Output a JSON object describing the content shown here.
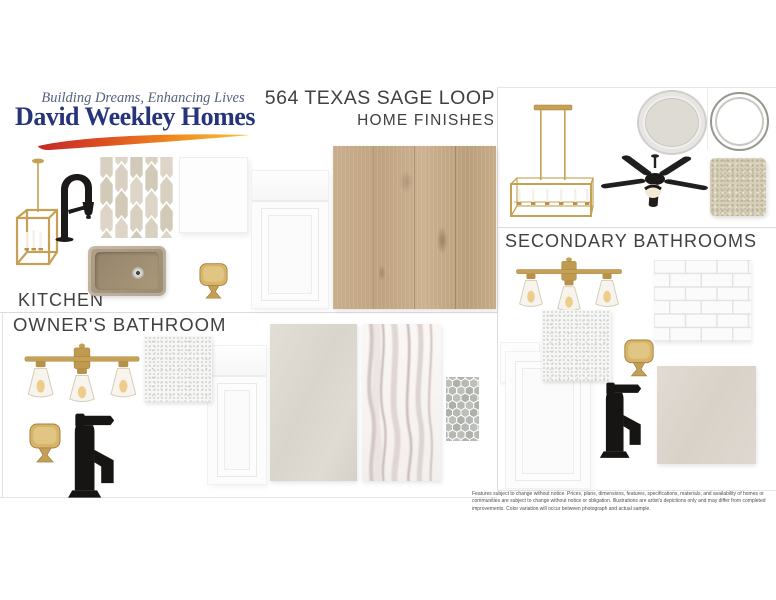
{
  "header": {
    "tagline": "Building Dreams, Enhancing Lives",
    "brand": "David Weekley Homes",
    "address": "564 TEXAS SAGE LOOP",
    "subtitle": "HOME FINISHES"
  },
  "sections": {
    "kitchen": "KITCHEN",
    "owners_bathroom": "OWNER'S BATHROOM",
    "secondary_bathrooms": "SECONDARY BATHROOMS"
  },
  "disclaimer": "Features subject to change without notice. Prices, plans, dimensions, features, specifications, materials, and availability of homes or communities are subject to change without notice or obligation. Illustrations are artist's depictions only and may differ from completed improvements. Color variation will occur between photograph and actual sample.",
  "colors": {
    "brand_navy": "#26357b",
    "tagline_blue_gray": "#566180",
    "heading_gray": "#414042",
    "brass_gold": "#c6a055",
    "matte_black": "#1c1a18",
    "swoosh_red": "#c22a27",
    "swoosh_orange": "#f08c1e",
    "swoosh_yellow": "#f6c33c",
    "sink_bronze": "#a3917a",
    "oak_floor": "#c3a887",
    "carpet_cream": "#d6cfba",
    "picket_tile_beige": "#d8d0c1",
    "hex_tile_gray": "#b6b9b3"
  },
  "products": {
    "kitchen": [
      "gold-lantern-pendant-light",
      "matte-black-pulldown-kitchen-faucet",
      "beige-picket-mosaic-tile",
      "white-square-tile",
      "bronze-single-bowl-kitchen-sink",
      "brass-cabinet-knob",
      "white-shaker-cabinet-door",
      "light-oak-wood-flooring"
    ],
    "owners_bathroom": [
      "brass-3-light-vanity-fixture",
      "white-speckled-quartz-sample",
      "brass-cabinet-knob",
      "matte-black-bathroom-faucet",
      "white-shaker-cabinet-door",
      "beige-large-format-tile",
      "white-marble-look-tile",
      "gray-hexagon-mosaic-tile"
    ],
    "secondary_bathrooms": [
      "brass-linear-chandelier",
      "paint-can-lid-light-gray",
      "paint-can-rim",
      "black-ceiling-fan-with-light",
      "cream-carpet-sample",
      "brass-3-light-vanity-fixture",
      "white-subway-tile",
      "white-sample-swatch",
      "white-speckled-quartz-sample",
      "brass-cabinet-knob",
      "white-shaker-cabinet-door",
      "matte-black-bathroom-faucet",
      "beige-floor-tile"
    ]
  }
}
